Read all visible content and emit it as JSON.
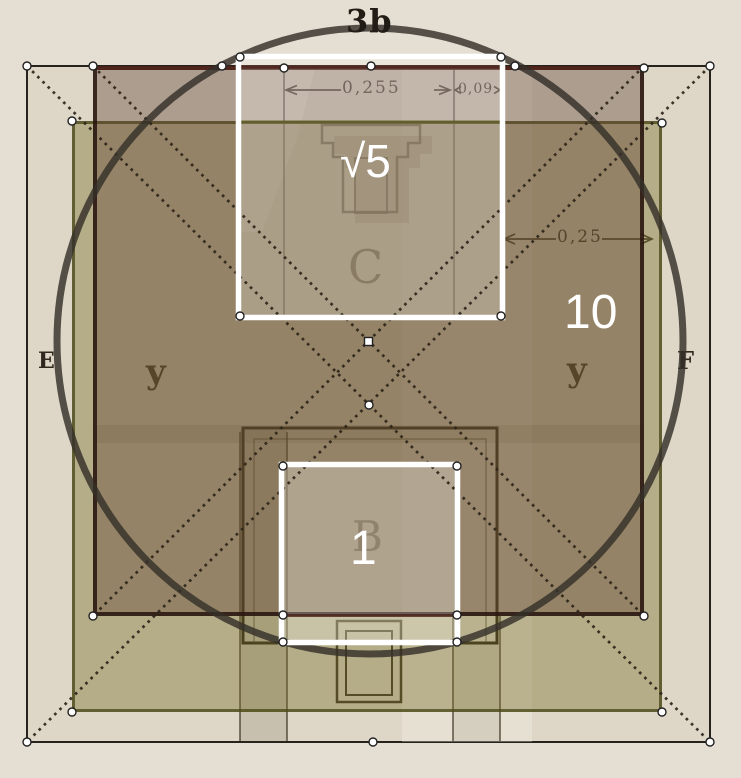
{
  "figure": {
    "top_label": "3b",
    "overlay_labels": {
      "sqrt5": "√5",
      "unit": "1",
      "ten": "10"
    },
    "plan_letters": {
      "c": "C",
      "b": "B",
      "e": "E",
      "f": "F",
      "y_left": "y",
      "y_right": "y"
    },
    "dimensions": {
      "top_main": "0,255",
      "top_small": "0,09",
      "right": "0,25"
    },
    "colors": {
      "paper": "#e5dfd3",
      "print_area": "#ded7c7",
      "olive_overlay": "rgba(120,110,40,0.40)",
      "dark_overlay": "rgba(95,62,50,0.38)",
      "circle": "#34302a",
      "dotted_line": "#2e251a",
      "maroon_line": "#4a231a",
      "olive_line": "#5c5a20",
      "white_square": "#ffffff",
      "ink": "#2a251d"
    }
  }
}
